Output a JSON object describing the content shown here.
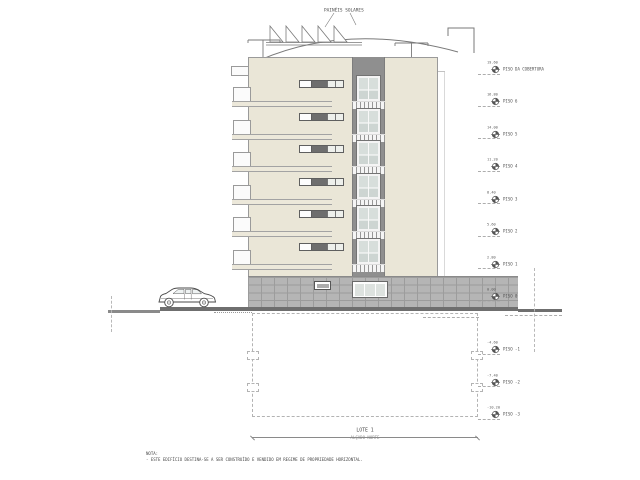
{
  "drawing": {
    "roof_label": "PAINÉIS SOLARES",
    "lot_title": "LOTE 1",
    "elevation_title": "ALÇADO NORTE",
    "note_heading": "NOTA:",
    "note_line": "- ESTE EDIFÍCIO DESTINA-SE A SER CONSTRUÍDO E VENDIDO EM REGIME DE PROPRIEDADE HORIZONTAL.",
    "colors": {
      "facade": "#eae6d7",
      "band": "#8f8f8f",
      "tile_wall": "#b5b5b5",
      "glass": "#d7dedb",
      "ground": "#6f6f6f"
    }
  },
  "building": {
    "upper_floor_count": 6,
    "basement_level_count": 3
  },
  "levels": [
    {
      "label": "PISO DA COBERTURA",
      "elevation": "19.60"
    },
    {
      "label": "PISO 6",
      "elevation": "16.80"
    },
    {
      "label": "PISO 5",
      "elevation": "14.00"
    },
    {
      "label": "PISO 4",
      "elevation": "11.20"
    },
    {
      "label": "PISO 3",
      "elevation": "8.40"
    },
    {
      "label": "PISO 2",
      "elevation": "5.60"
    },
    {
      "label": "PISO 1",
      "elevation": "2.80"
    },
    {
      "label": "PISO 0",
      "elevation": "0.00"
    },
    {
      "label": "PISO -1",
      "elevation": "-4.60"
    },
    {
      "label": "PISO -2",
      "elevation": "-7.40"
    },
    {
      "label": "PISO -3",
      "elevation": "-10.20"
    }
  ]
}
